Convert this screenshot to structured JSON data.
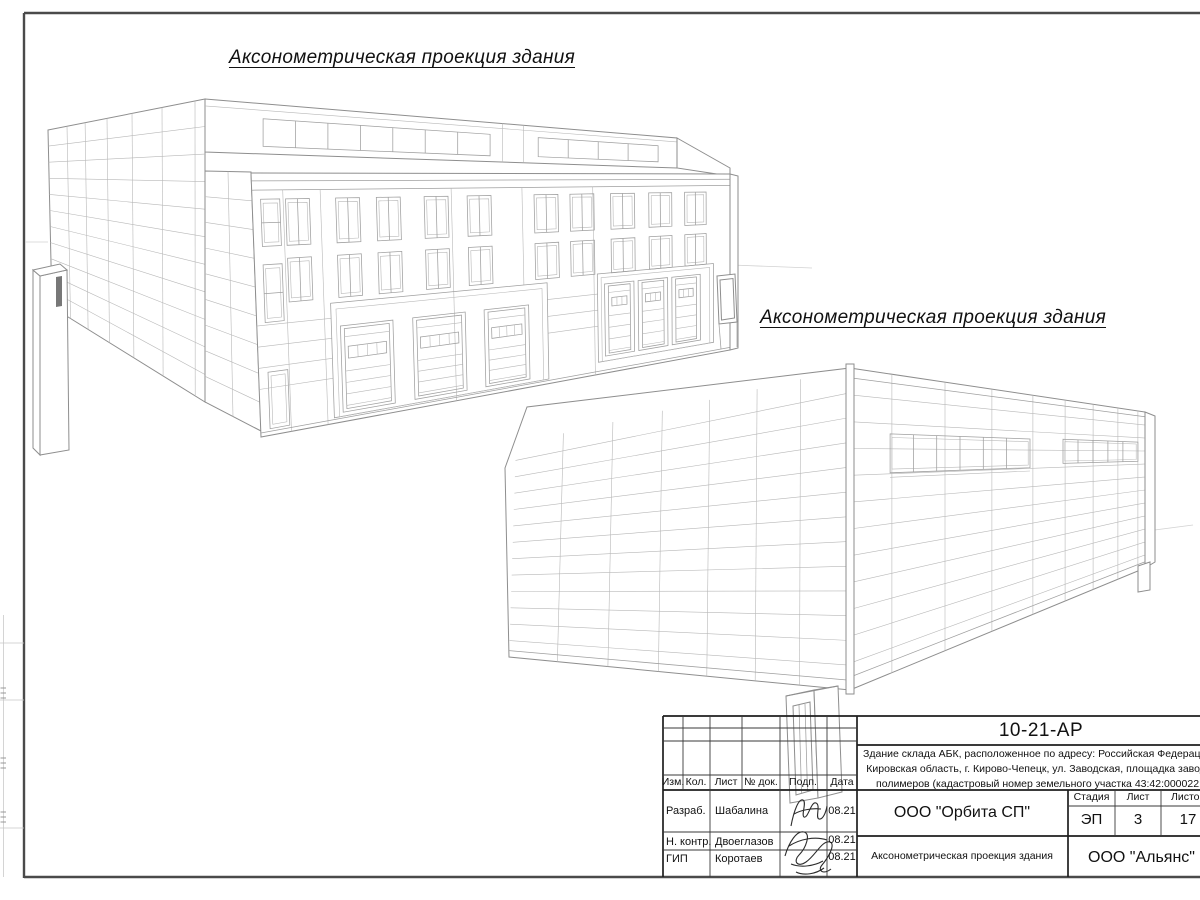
{
  "sheet": {
    "titles": {
      "projection_top": "Аксонометрическая проекция здания",
      "projection_side": "Аксонометрическая проекция здания"
    },
    "stamp": {
      "doc_number": "10-21-АР",
      "description_line1": "Здание склада АБК, расположенное по адресу: Российская Федерация,",
      "description_line2": "Кировская область, г. Кирово-Чепецк, ул. Заводская, площадка завода",
      "description_line3": "полимеров (кадастровый номер земельного участка 43:42:000022:",
      "col_izm": "Изм.",
      "col_kol": "Кол.",
      "col_list": "Лист",
      "col_doc": "№ док.",
      "col_podp": "Подп.",
      "col_data": "Дата",
      "row1_role": "Разраб.",
      "row1_name": "Шабалина",
      "row1_date": "08.21",
      "row2_role": "Н. контр.",
      "row2_name": "Двоеглазов",
      "row2_date": "08.21",
      "row3_role": "ГИП",
      "row3_name": "Коротаев",
      "row3_date": "08.21",
      "org": "ООО \"Орбита СП\"",
      "stage_label": "Стадия",
      "sheet_label": "Лист",
      "sheets_label": "Листов",
      "stage": "ЭП",
      "sheet_num": "3",
      "sheets_total": "17",
      "drawing_name": "Аксонометрическая проекция здания",
      "org2": "ООО \"Альянс\""
    }
  }
}
